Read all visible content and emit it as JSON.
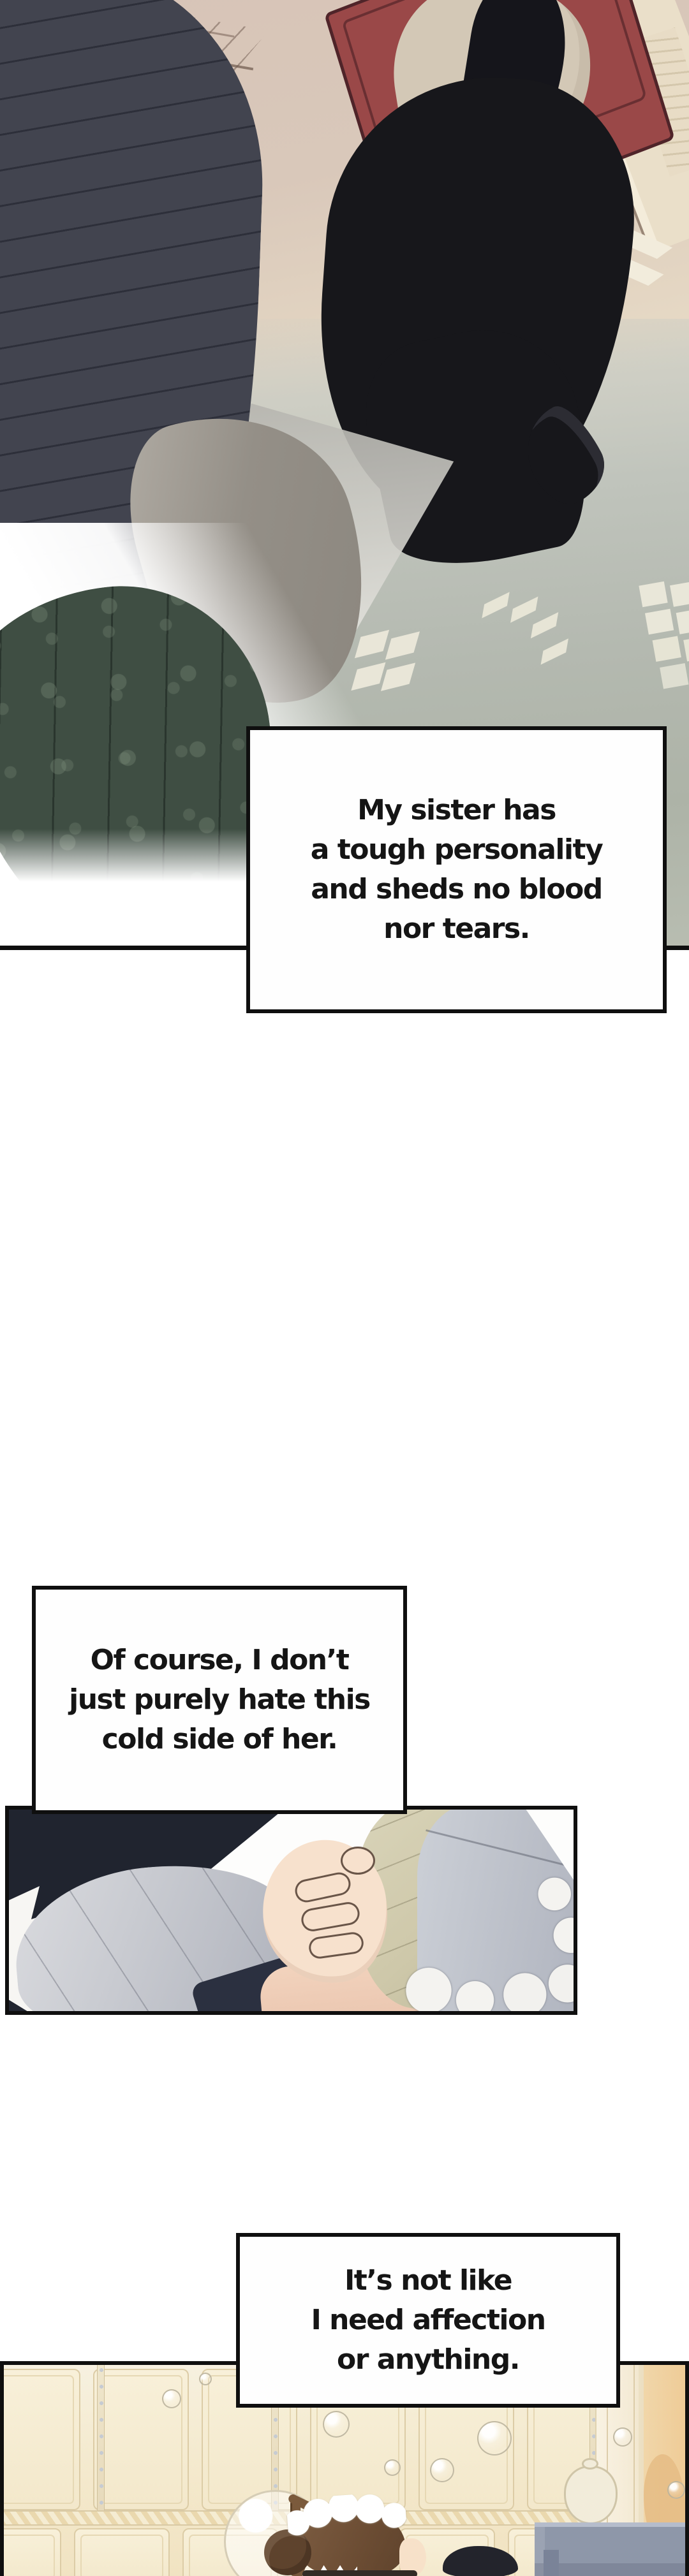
{
  "narration": {
    "box1": {
      "lines": [
        "My sister has",
        "a tough personality",
        "and sheds no blood",
        "nor tears."
      ]
    },
    "box2": {
      "lines": [
        "Of course, I don’t",
        "just purely hate this",
        "cold side of her."
      ]
    },
    "box3": {
      "lines": [
        "It’s not like",
        "I need affection",
        "or anything."
      ]
    }
  },
  "palette": {
    "ink_text": "#151515",
    "panel_border": "#0f0f0f",
    "hall_wall_beige": "#d8c5b8",
    "hall_floor_cream": "#eee3cf",
    "door_red": "#9a4848",
    "door_outline": "#4f2429",
    "door_gold": "#e5cd9c",
    "sister_hair_black": "#15151b",
    "sister_blouse_beige": "#d3c8b6",
    "heroine_hair_slate": "#42444f",
    "heroine_dress_green": "#3f4e43",
    "shawl_gray": "#948f87",
    "shadow_sage": "#adb3a7",
    "window_light": "#e9e7d9",
    "grip_cloth_khaki": "#cfc9ab",
    "bed_fabric_gray": "#c9cbd1",
    "blanket_gray": "#bcc0c9",
    "skin": "#f7e1cd",
    "bath_wall_cream": "#f3e8cb",
    "bath_panel_line": "#dccca6",
    "bath_wall_orange": "#eeca94",
    "cabinet_gray_blue": "#8e97a9",
    "maid_hair_brown": "#6b4c33"
  }
}
